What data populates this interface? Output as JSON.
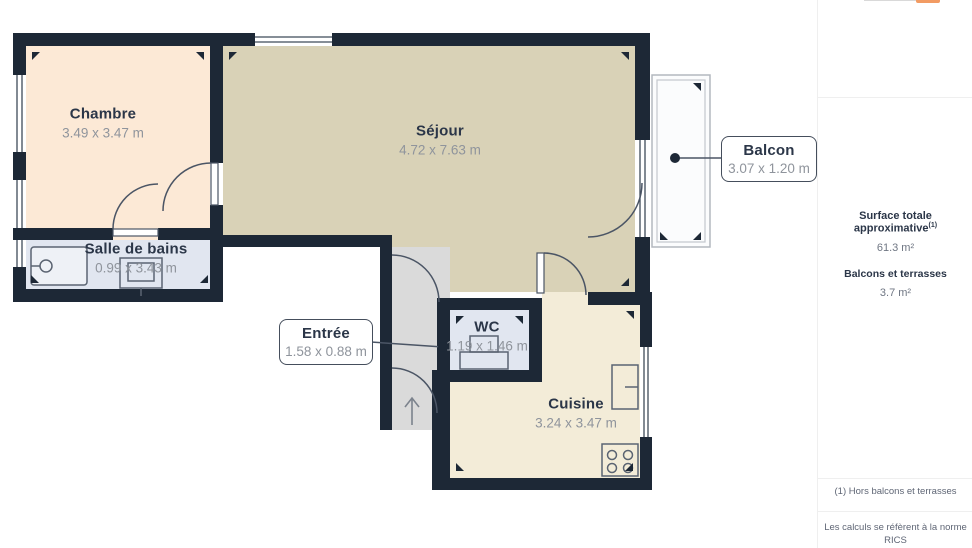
{
  "palette": {
    "wall": "#1d2836",
    "floor_chambre": "#fce9d6",
    "floor_sejour": "#d9d2b7",
    "floor_wetroom": "#e1e6f0",
    "floor_entree": "#dadada",
    "floor_cuisine": "#f3ecd8",
    "balcony_fill": "#fbfcfd",
    "label_text": "#2b3648",
    "dims_text": "#8f949c",
    "accent_orange": "#f29b63",
    "divider": "#efefef",
    "muted_text": "#5f6675"
  },
  "plan": {
    "rooms": [
      {
        "name": "Chambre",
        "dims": "3.49 x 3.47 m"
      },
      {
        "name": "Séjour",
        "dims": "4.72 x 7.63 m"
      },
      {
        "name": "Salle de bains",
        "dims": "0.99 x 3.43 m"
      },
      {
        "name": "WC",
        "dims": "1.19 x 1.46 m"
      },
      {
        "name": "Cuisine",
        "dims": "3.24 x 3.47 m"
      }
    ],
    "callouts": [
      {
        "name": "Entrée",
        "dims": "1.58 x 0.88 m"
      },
      {
        "name": "Balcon",
        "dims": "3.07 x 1.20 m"
      }
    ]
  },
  "sidebar": {
    "surface_title": "Surface totale approximative",
    "surface_ref": "(1)",
    "surface_value": "61.3 m²",
    "balconies_title": "Balcons et terrasses",
    "balconies_value": "3.7 m²",
    "footnote": "(1) Hors balcons et terrasses",
    "disclaimer_line1": "Les calculs se réfèrent à la norme RICS",
    "disclaimer_line2": "IPMS 3C. Toutes les mesures sont"
  }
}
